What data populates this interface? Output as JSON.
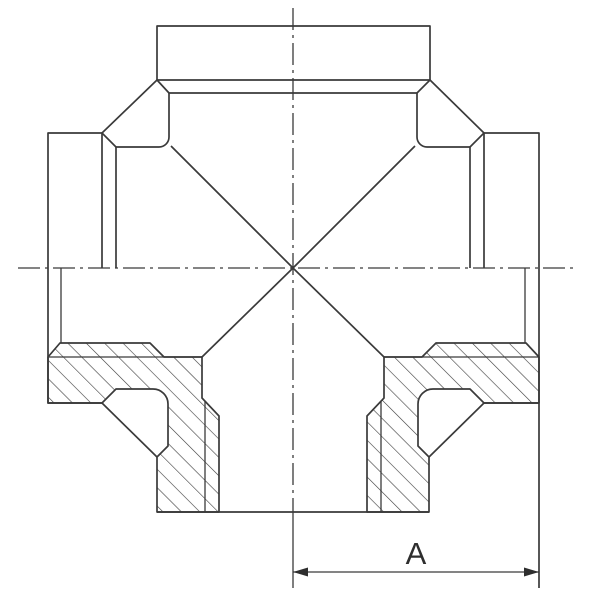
{
  "drawing": {
    "kind": "pipe-cross-fitting-half-section",
    "dimension": {
      "label": "A"
    },
    "colors": {
      "line": "#3a3a3a",
      "background": "#ffffff"
    }
  }
}
